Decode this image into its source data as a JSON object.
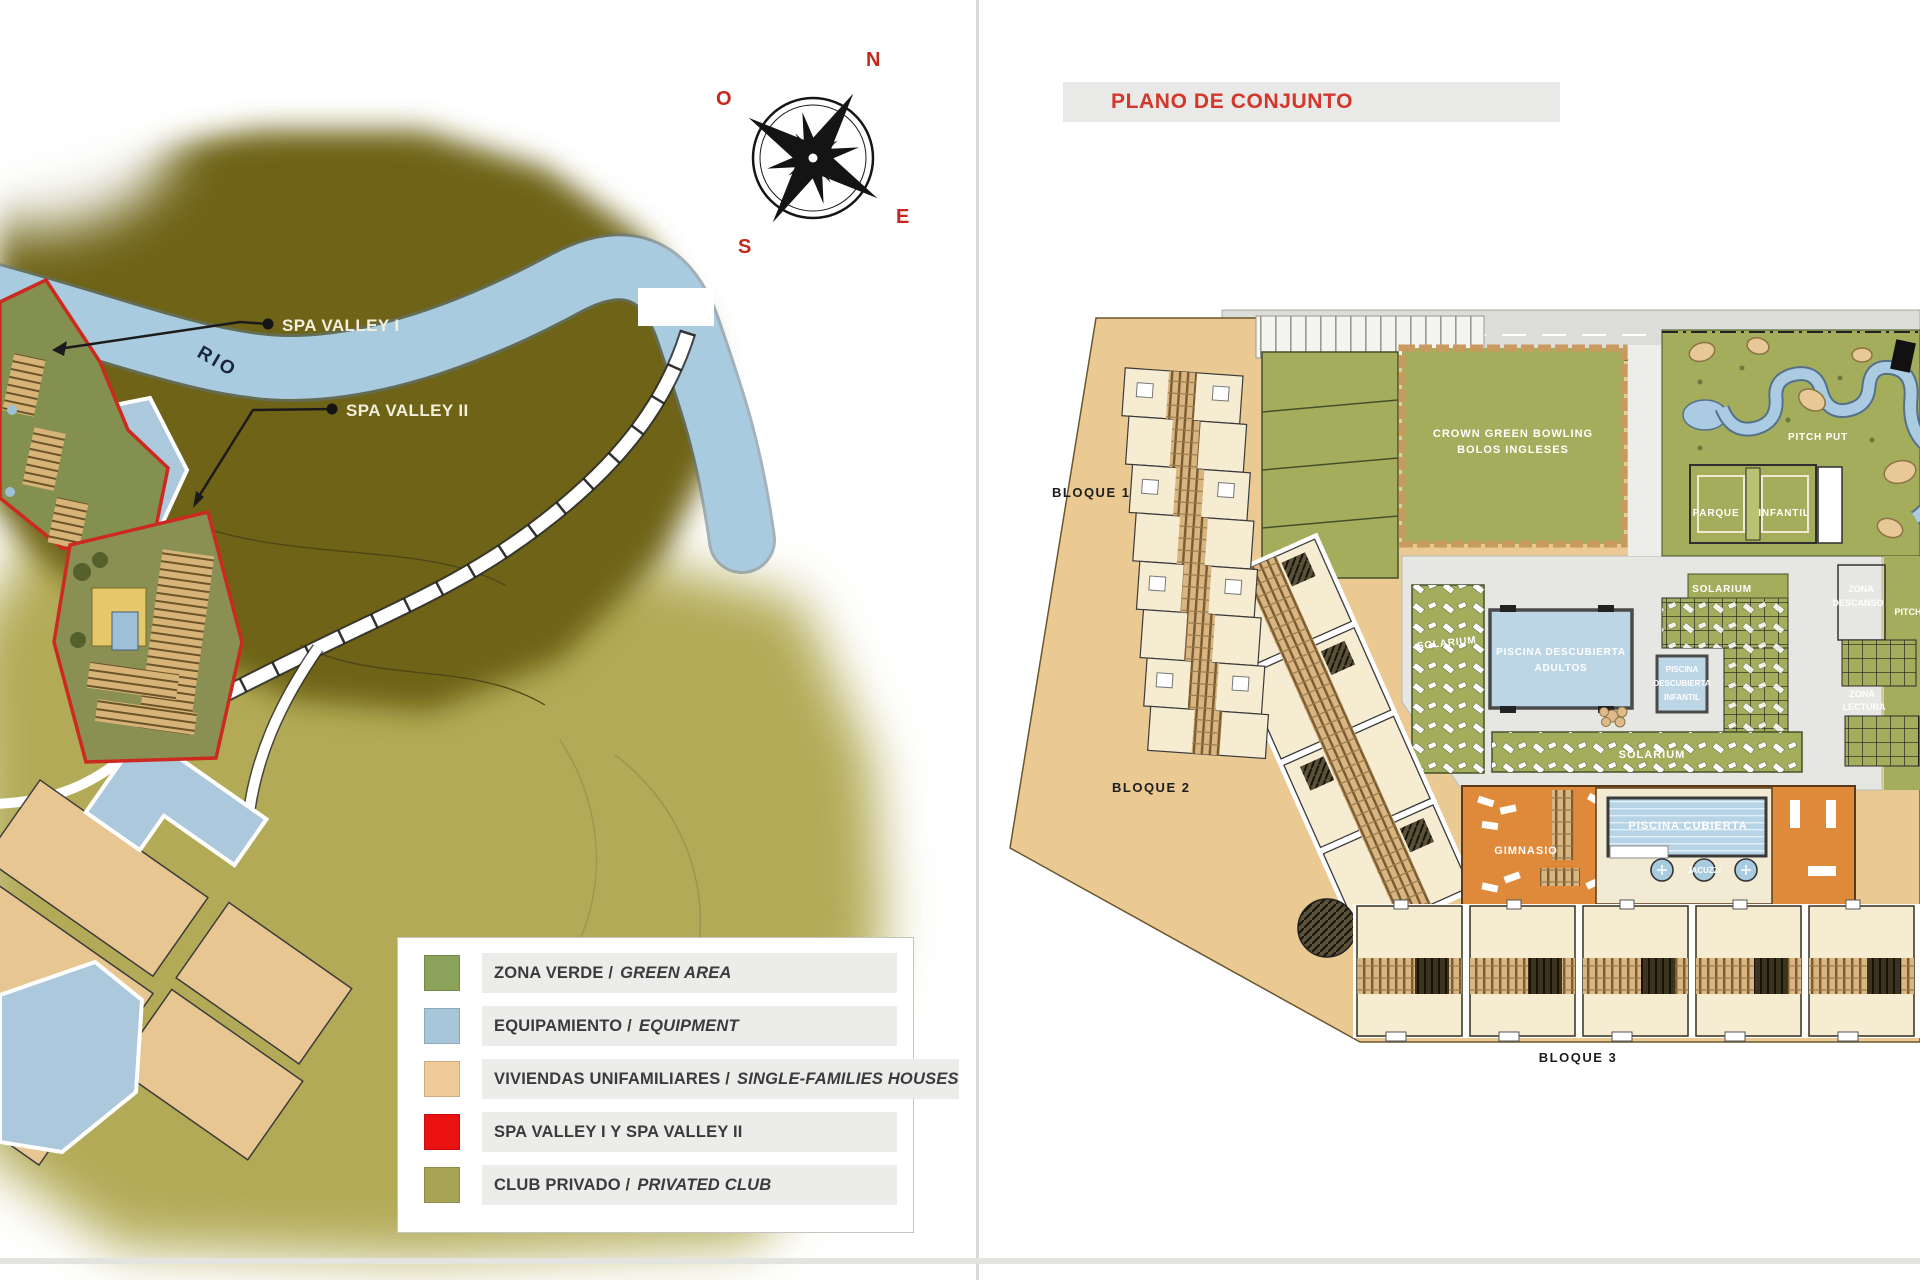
{
  "left": {
    "compass": {
      "n": "N",
      "e": "E",
      "s": "S",
      "o": "O"
    },
    "river": "RIO",
    "callout1": "SPA VALLEY I",
    "callout2": "SPA VALLEY II",
    "legend": {
      "items": [
        {
          "es": "ZONA VERDE /",
          "en": "GREEN AREA",
          "color": "#8ba25b"
        },
        {
          "es": "EQUIPAMIENTO /",
          "en": "EQUIPMENT",
          "color": "#a7c6da"
        },
        {
          "es": "VIVIENDAS UNIFAMILIARES /",
          "en": "SINGLE-FAMILIES HOUSES",
          "color": "#efcb9a"
        },
        {
          "es": "SPA VALLEY I Y SPA VALLEY II",
          "en": "",
          "color": "#ea1111"
        },
        {
          "es": "CLUB PRIVADO /",
          "en": "PRIVATED CLUB",
          "color": "#a8a455"
        }
      ]
    }
  },
  "right": {
    "title": "PLANO DE CONJUNTO",
    "blocks": {
      "b1": "BLOQUE 1",
      "b2": "BLOQUE 2",
      "b3": "BLOQUE 3"
    },
    "areas": {
      "bowling_l1": "CROWN GREEN BOWLING",
      "bowling_l2": "BOLOS INGLESES",
      "pitch_put": "PITCH PUT",
      "parque_l1": "PARQUE",
      "parque_l2": "INFANTIL",
      "solarium": "SOLARIUM",
      "pool_adult_l1": "PISCINA DESCUBIERTA",
      "pool_adult_l2": "ADULTOS",
      "pool_kid_l1": "PISCINA",
      "pool_kid_l2": "DESCUBIERTA",
      "pool_kid_l3": "INFANTIL",
      "descanso_l1": "ZONA",
      "descanso_l2": "DESCANSO",
      "lectura_l1": "ZONA",
      "lectura_l2": "LECTURA",
      "pitch_edge": "PITCH",
      "gym": "GIMNASIO",
      "pool_indoor": "PISCINA CUBIERTA",
      "jacuzzi": "JACUZZI"
    }
  },
  "colors": {
    "accent_red": "#d3372b",
    "hill_dark": "#6e6316",
    "grass_light": "#b2aa57",
    "river_blue": "#a9cbe0",
    "plan_green": "#a4ad5c",
    "plan_tan": "#eac993",
    "plan_cream": "#f6ecd2",
    "pool_blue": "#b7d3e6",
    "spa_orange": "#df8a3b",
    "plaza_gray": "#e6e6e2"
  }
}
